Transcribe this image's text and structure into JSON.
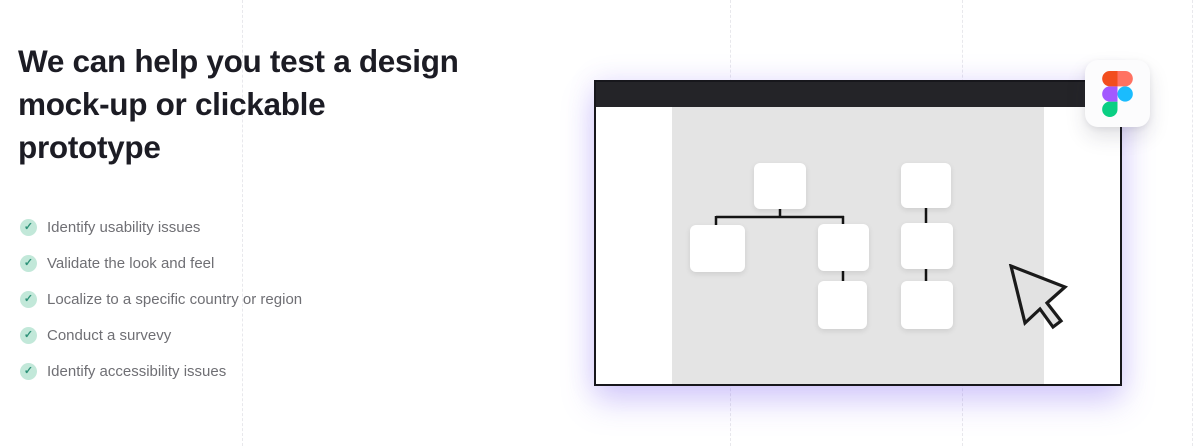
{
  "hero": {
    "heading": "We can help you test a design\nmock-up or clickable\nprototype"
  },
  "checklist": {
    "check_glyph": "✓",
    "items": [
      {
        "label": "Identify usability issues"
      },
      {
        "label": "Validate the look and feel"
      },
      {
        "label": "Localize to a specific country or region"
      },
      {
        "label": "Conduct a survevy"
      },
      {
        "label": "Identify accessibility issues"
      }
    ]
  },
  "colors": {
    "heading_text": "#1c1c24",
    "list_text": "#6f6f74",
    "check_circle_bg": "#c2e8d9",
    "check_mark": "#2f9279",
    "window_border": "#17171c",
    "window_titlebar": "#242428",
    "canvas_gray": "#e4e4e4",
    "window_glow": "#7658f0",
    "figma_red": "#F24E1E",
    "figma_salmon": "#FF7262",
    "figma_purple": "#A259FF",
    "figma_blue": "#1ABCFE",
    "figma_green": "#0ACF83"
  }
}
